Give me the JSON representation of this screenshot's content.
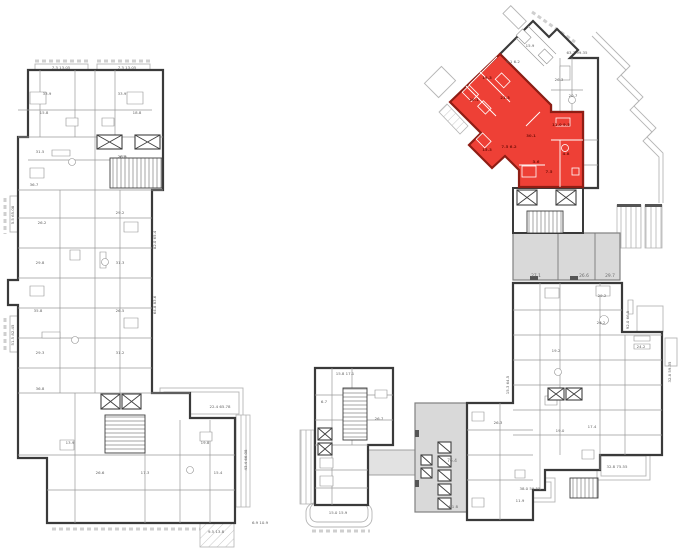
{
  "plan": {
    "type": "architectural-floor-plan",
    "background": "#ffffff",
    "palette": {
      "wall": "#3a3a3a",
      "thin_line": "#9a9a9a",
      "terrace_line": "#b5b5b5",
      "corridor_fill": "#d9d9d9",
      "plaza_fill": "#e2e2e2",
      "label": "#5f5f5f"
    },
    "selected_unit": {
      "fill": "#ee4036",
      "wall": "#8f1d14",
      "label_color": "#7c120b",
      "status": "highlighted"
    },
    "corridor_cells": [
      "27.1",
      "26.6",
      "29.7"
    ],
    "labels": [
      {
        "t": "7.3 13.05",
        "x": 61,
        "y": 69
      },
      {
        "t": "7.3 13.05",
        "x": 127,
        "y": 69
      },
      {
        "t": "33.9",
        "x": 47,
        "y": 95
      },
      {
        "t": "33.9",
        "x": 122,
        "y": 95
      },
      {
        "t": "15.8",
        "x": 44,
        "y": 114
      },
      {
        "t": "18.8",
        "x": 137,
        "y": 114
      },
      {
        "t": "31.5",
        "x": 40,
        "y": 153
      },
      {
        "t": "26.8",
        "x": 122,
        "y": 158
      },
      {
        "t": "36.7",
        "x": 34,
        "y": 186
      },
      {
        "t": "29.2",
        "x": 120,
        "y": 214
      },
      {
        "t": "26.2",
        "x": 42,
        "y": 224
      },
      {
        "t": "31.3",
        "x": 120,
        "y": 264
      },
      {
        "t": "29.8",
        "x": 40,
        "y": 264
      },
      {
        "t": "35.8",
        "x": 38,
        "y": 312
      },
      {
        "t": "26.5",
        "x": 120,
        "y": 312
      },
      {
        "t": "29.3",
        "x": 40,
        "y": 354
      },
      {
        "t": "31.2",
        "x": 120,
        "y": 354
      },
      {
        "t": "36.8",
        "x": 40,
        "y": 390
      },
      {
        "t": "22.4 65.78",
        "x": 220,
        "y": 408
      },
      {
        "t": "13.9",
        "x": 70,
        "y": 444
      },
      {
        "t": "26.6",
        "x": 100,
        "y": 474
      },
      {
        "t": "17.3",
        "x": 145,
        "y": 474
      },
      {
        "t": "19.8",
        "x": 205,
        "y": 444
      },
      {
        "t": "15.4",
        "x": 218,
        "y": 474
      },
      {
        "t": "9.5 13.8",
        "x": 216,
        "y": 533
      },
      {
        "t": "6.9 10.9",
        "x": 260,
        "y": 524
      },
      {
        "t": "5.5 65.08",
        "x": 14,
        "y": 215,
        "r": -90
      },
      {
        "t": "51.5 82.45",
        "x": 14,
        "y": 335,
        "r": -90
      },
      {
        "t": "82.0 65.4",
        "x": 156,
        "y": 240,
        "r": -90
      },
      {
        "t": "64.8 83.6",
        "x": 156,
        "y": 305,
        "r": -90
      },
      {
        "t": "43.4 66.08",
        "x": 247,
        "y": 460,
        "r": -90
      },
      {
        "t": "15.8 17.1",
        "x": 345,
        "y": 375
      },
      {
        "t": "6.7",
        "x": 324,
        "y": 403
      },
      {
        "t": "26.7",
        "x": 379,
        "y": 420
      },
      {
        "t": "15.0 15.9",
        "x": 338,
        "y": 514
      },
      {
        "t": "76.4",
        "x": 452,
        "y": 462,
        "c": "gray"
      },
      {
        "t": "4.1 8",
        "x": 453,
        "y": 508
      },
      {
        "t": "26.3",
        "x": 498,
        "y": 424
      },
      {
        "t": "11.9",
        "x": 520,
        "y": 502
      },
      {
        "t": "17.4",
        "x": 592,
        "y": 428
      },
      {
        "t": "27.1",
        "x": 536,
        "y": 277,
        "c": "gray"
      },
      {
        "t": "26.6",
        "x": 584,
        "y": 277,
        "c": "gray"
      },
      {
        "t": "29.7",
        "x": 610,
        "y": 277,
        "c": "gray"
      },
      {
        "t": "29.2",
        "x": 602,
        "y": 297
      },
      {
        "t": "26.2",
        "x": 601,
        "y": 324
      },
      {
        "t": "24.2",
        "x": 641,
        "y": 348
      },
      {
        "t": "19.2",
        "x": 556,
        "y": 352
      },
      {
        "t": "19.0",
        "x": 560,
        "y": 432
      },
      {
        "t": "32.8 75.55",
        "x": 617,
        "y": 468
      },
      {
        "t": "38.0 59.55",
        "x": 530,
        "y": 490
      },
      {
        "t": "92.0 66.5",
        "x": 629,
        "y": 320,
        "r": -90
      },
      {
        "t": "32.8 59.35",
        "x": 671,
        "y": 372,
        "r": -90
      },
      {
        "t": "15.3 64.5",
        "x": 509,
        "y": 385,
        "r": -90
      },
      {
        "t": "8.1 6.2",
        "x": 513,
        "y": 63
      },
      {
        "t": "63.7 99.35",
        "x": 577,
        "y": 54
      },
      {
        "t": "26.3",
        "x": 559,
        "y": 81
      },
      {
        "t": "20.7",
        "x": 573,
        "y": 97
      },
      {
        "t": "15.9",
        "x": 530,
        "y": 47
      },
      {
        "t": "19.3",
        "x": 487,
        "y": 79,
        "c": "red"
      },
      {
        "t": "20.1",
        "x": 474,
        "y": 101,
        "c": "red"
      },
      {
        "t": "21.3",
        "x": 505,
        "y": 99,
        "c": "red"
      },
      {
        "t": "15.3",
        "x": 487,
        "y": 151,
        "c": "red"
      },
      {
        "t": "30.1",
        "x": 531,
        "y": 137,
        "c": "red"
      },
      {
        "t": "11.0 9.5",
        "x": 561,
        "y": 126,
        "c": "red"
      },
      {
        "t": "4.8",
        "x": 566,
        "y": 155,
        "c": "red"
      },
      {
        "t": "3.6",
        "x": 536,
        "y": 163,
        "c": "red"
      },
      {
        "t": "7.5",
        "x": 549,
        "y": 173,
        "c": "red"
      },
      {
        "t": "7.5 6.2",
        "x": 509,
        "y": 148,
        "c": "red"
      }
    ]
  }
}
